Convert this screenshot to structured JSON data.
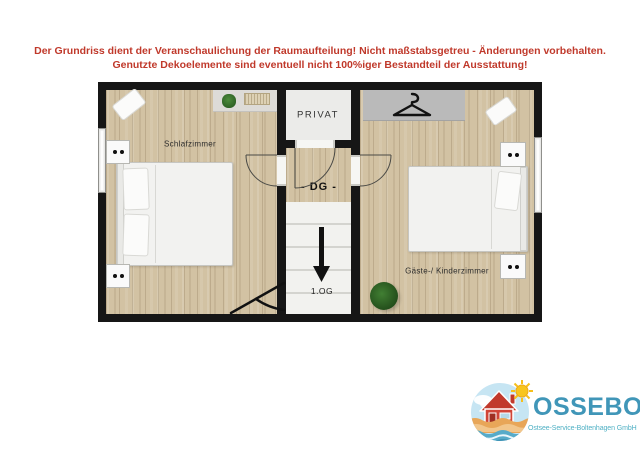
{
  "disclaimer": {
    "line1": "Der Grundriss dient der Veranschaulichung der Raumaufteilung! Nicht maßstabsgetreu - Änderungen vorbehalten.",
    "line2": "Genutzte Dekoelemente sind eventuell nicht 100%iger Bestandteil der Ausstattung!",
    "color": "#c0392b"
  },
  "plan": {
    "floor_label": "- DG -",
    "rooms": {
      "schlafzimmer": {
        "label": "Schlafzimmer"
      },
      "kinderzimmer": {
        "label": "Gäste-/ Kinderzimmer"
      },
      "privat": {
        "label": "PRIVAT"
      }
    },
    "stairs": {
      "direction": "down",
      "target_label": "1.OG"
    },
    "colors": {
      "wall": "#161616",
      "wood_floor": "#d2c2a3",
      "stairs": "#f2f2ef",
      "wardrobe": "#bababa"
    }
  },
  "icons": {
    "hanger": "clothes-hanger",
    "stairs_arrow": "arrow-down",
    "plants": "potted-plant",
    "logo_emblem": "house-sun-beach-waves"
  },
  "logo": {
    "name": "OSSEBO",
    "subtitle": "Ostsee-Service-Boltenhagen GmbH",
    "colors": {
      "name_text": "#4096b8",
      "subtitle_text": "#4fb0c4",
      "house": "#d04538",
      "sun": "#f8c51c",
      "sand": "#e8a658",
      "water": "#57abc9",
      "sky": "#c6e5f3"
    }
  }
}
